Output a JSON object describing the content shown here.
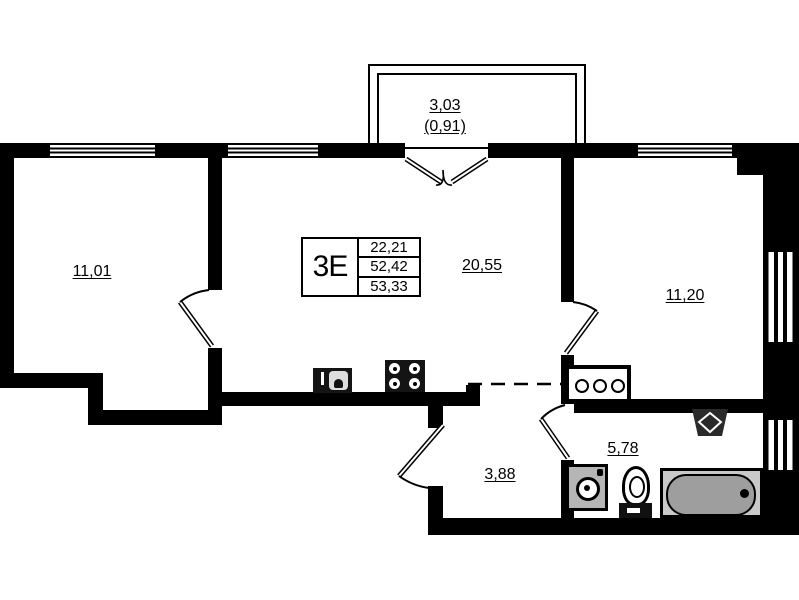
{
  "balcony": {
    "area": "3,03",
    "coefficient_area": "(0,91)"
  },
  "legend": {
    "type": "3Е",
    "living_area": "22,21",
    "area": "52,42",
    "total_area": "53,33"
  },
  "rooms": {
    "bedroom_left": "11,01",
    "living_kitchen": "20,55",
    "bedroom_right": "11,20",
    "hall": "3,88",
    "bathroom": "5,78"
  },
  "colors": {
    "wall": "#000000",
    "bg": "#ffffff",
    "tub-frame": "#c9c9c9",
    "tub-inner": "#9e9e9e",
    "appliance": "#b5b5b5",
    "dark-fixture": "#141414"
  }
}
